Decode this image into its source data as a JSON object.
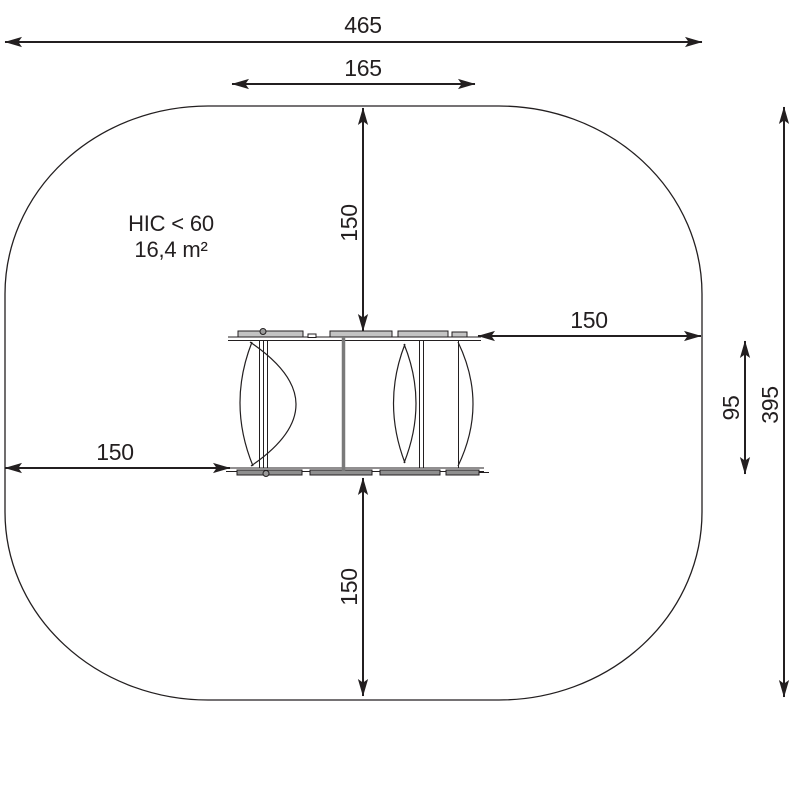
{
  "drawing": {
    "kind": "playground-equipment-safety-zone-top-view",
    "annotation": {
      "hic": "HIC < 60",
      "area": "16,4 m²"
    },
    "dimensions": {
      "overall_width": "465",
      "equipment_width": "165",
      "clearance_top": "150",
      "clearance_right": "150",
      "clearance_left": "150",
      "clearance_bottom": "150",
      "equipment_depth": "95",
      "overall_depth": "395"
    },
    "colors": {
      "line": "#231f20",
      "background": "#ffffff",
      "plank_light": "#c3c3c3",
      "plank_dark": "#8f8f8f",
      "post_gray": "#7a7a7a"
    }
  }
}
